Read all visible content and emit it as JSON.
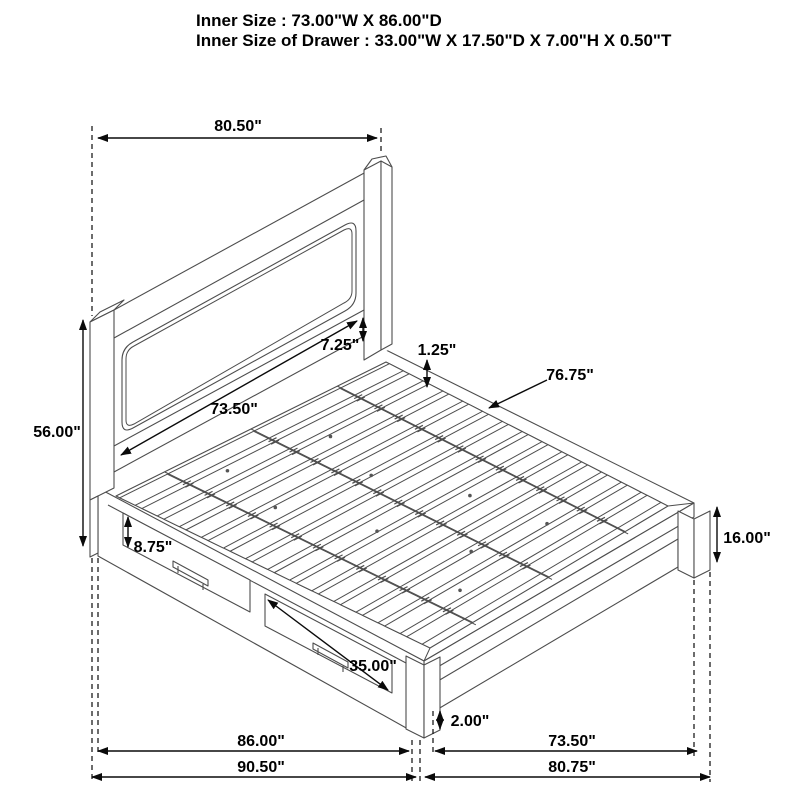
{
  "header": {
    "line1": "Inner Size : 73.00\"W X 86.00\"D",
    "line2": "Inner Size of Drawer : 33.00\"W X 17.50\"D X 7.00\"H X 0.50\"T"
  },
  "dimensions": {
    "headboard_width": "80.50\"",
    "headboard_height": "56.00\"",
    "headboard_inner_width": "73.50\"",
    "headboard_panel_gap": "7.25\"",
    "slat_thickness": "1.25\"",
    "slat_length": "76.75\"",
    "drawer_front_height": "8.75\"",
    "drawer_width": "35.00\"",
    "foot_clearance": "2.00\"",
    "footboard_height": "16.00\"",
    "side_inner_depth": "86.00\"",
    "side_outer_depth": "90.50\"",
    "foot_inner_width": "73.50\"",
    "foot_outer_width": "80.75\""
  },
  "colors": {
    "background": "#ffffff",
    "drawing_line": "#4d4d4d",
    "dimension_line": "#0a0a0a",
    "text": "#000000"
  }
}
